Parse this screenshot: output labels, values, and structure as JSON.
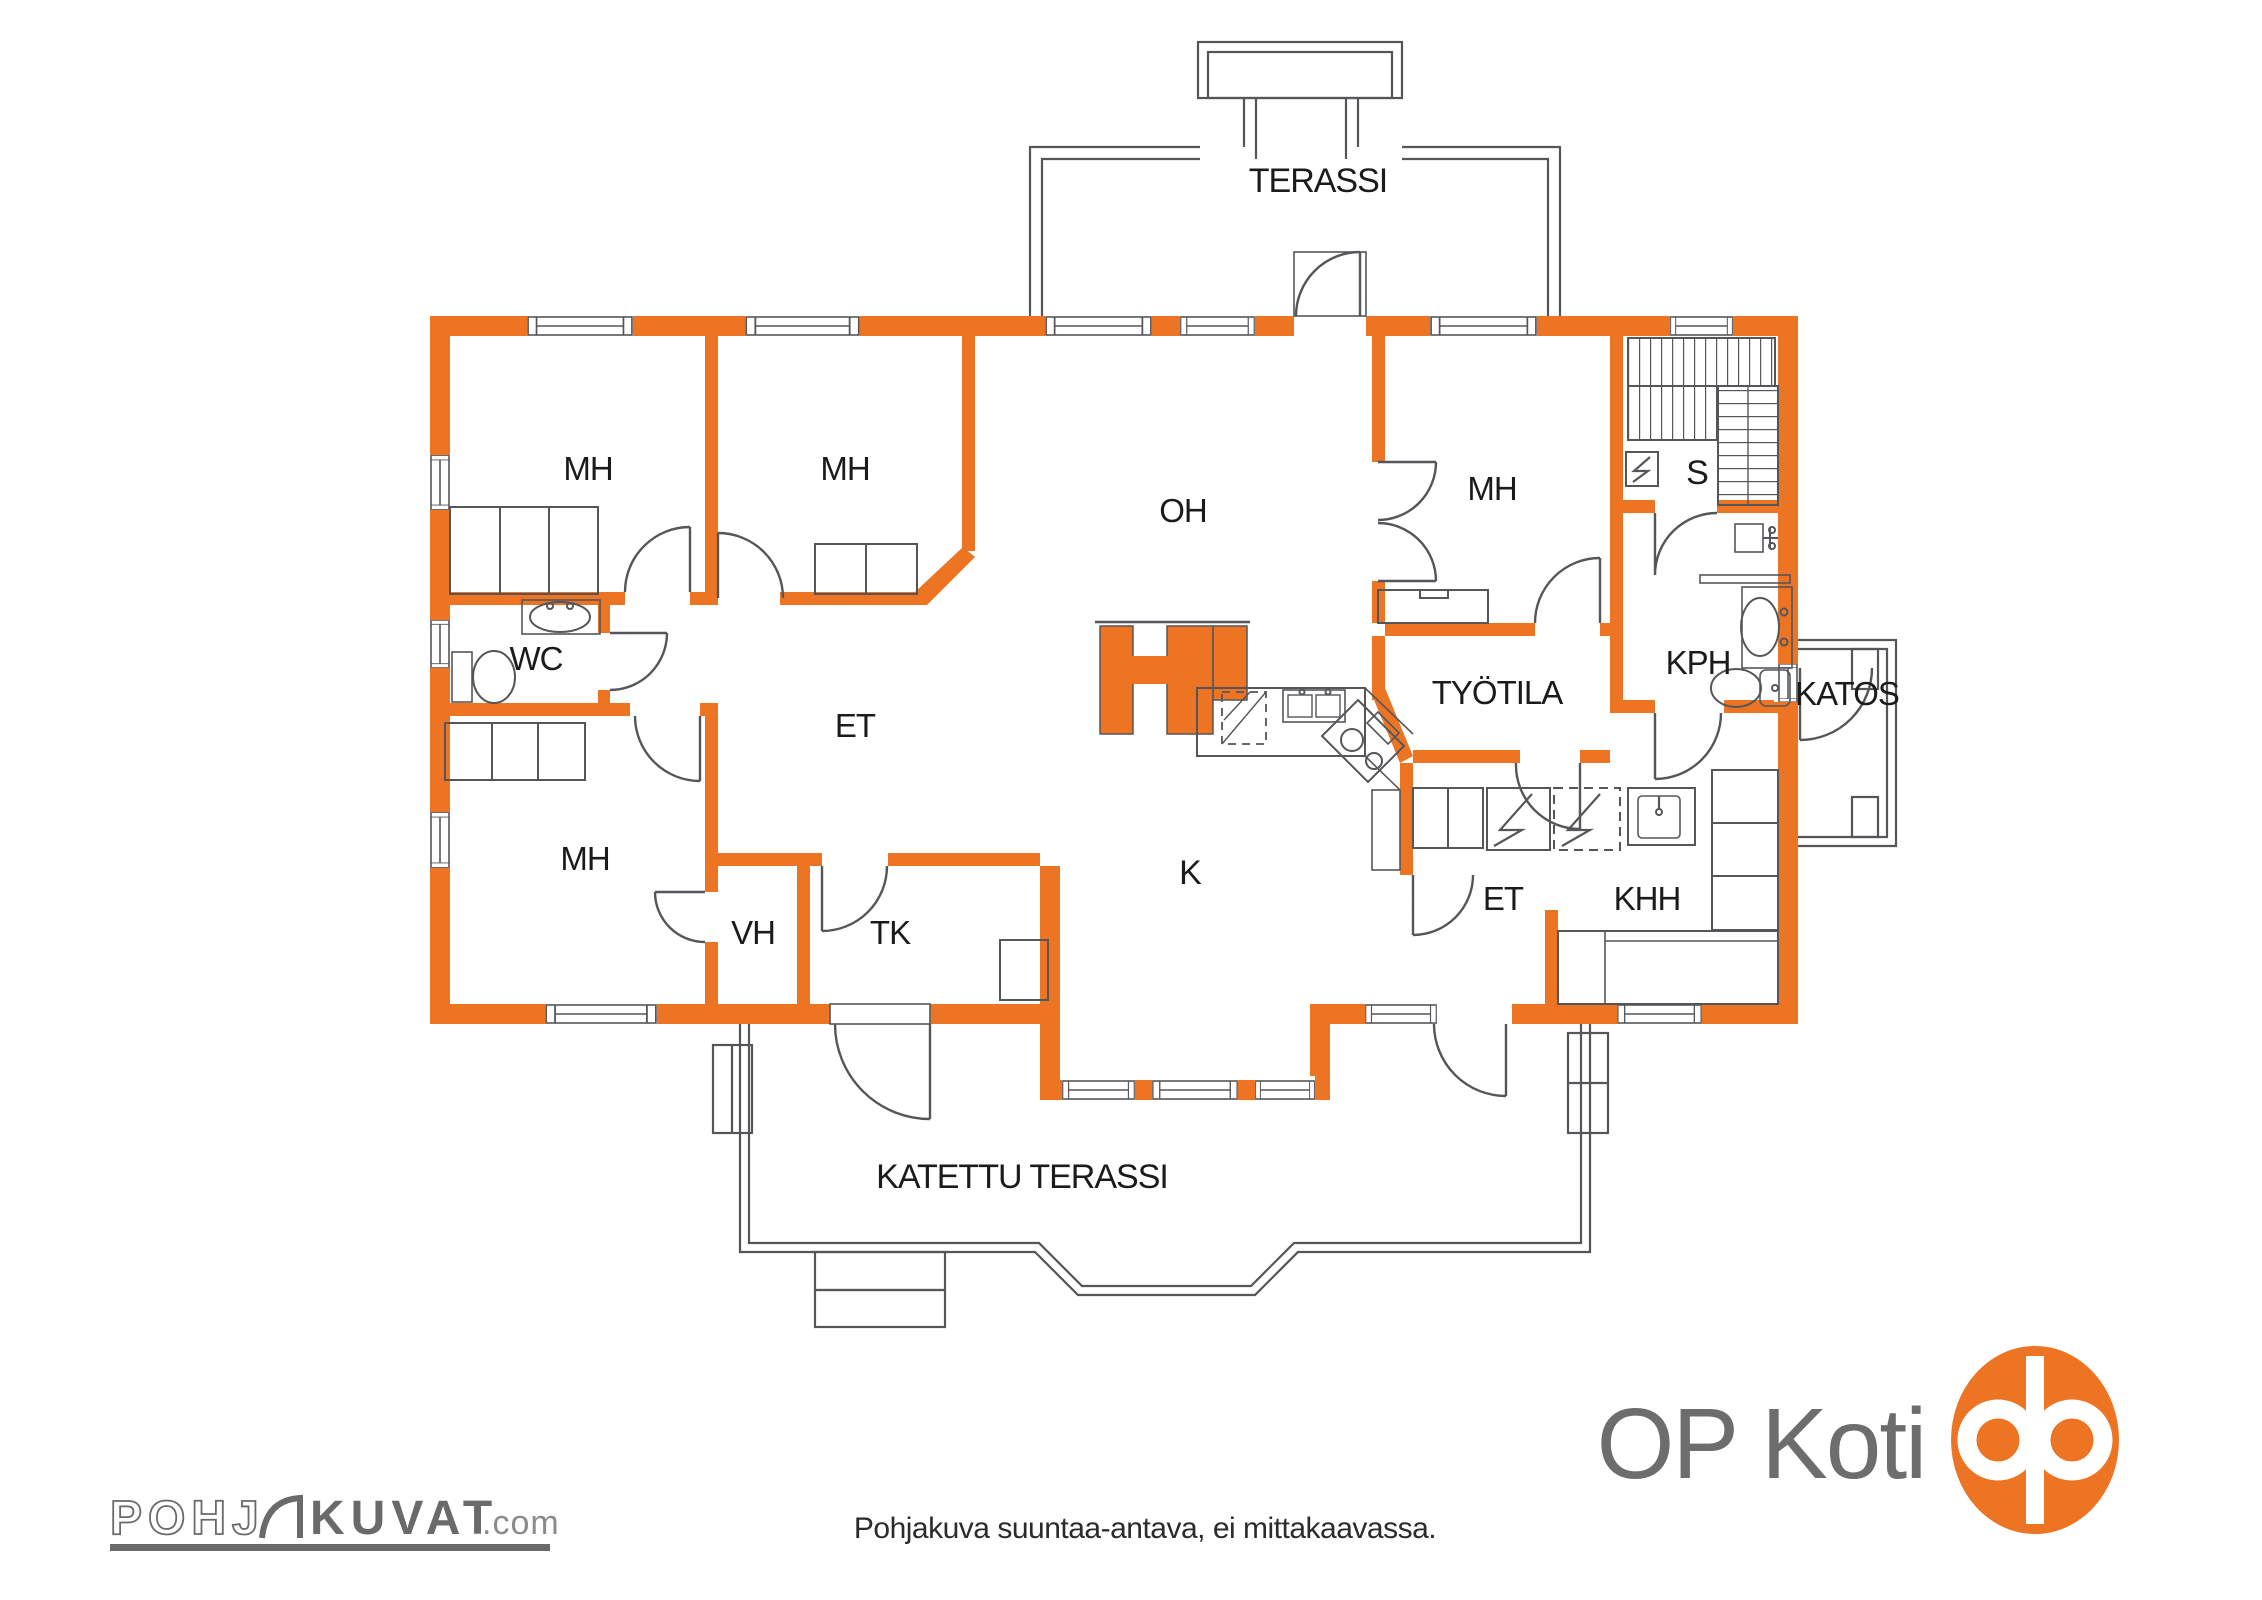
{
  "colors": {
    "wall_orange": "#ED7423",
    "line_gray": "#54565A",
    "text_black": "#1B1B1B",
    "logo_gray": "#6D6D6E"
  },
  "rooms": [
    {
      "id": "terassi",
      "label": "TERASSI"
    },
    {
      "id": "mh-top-left",
      "label": "MH"
    },
    {
      "id": "mh-top-mid",
      "label": "MH"
    },
    {
      "id": "oh",
      "label": "OH"
    },
    {
      "id": "mh-top-right",
      "label": "MH"
    },
    {
      "id": "sauna",
      "label": "S"
    },
    {
      "id": "wc",
      "label": "WC"
    },
    {
      "id": "et-hall",
      "label": "ET"
    },
    {
      "id": "kph",
      "label": "KPH"
    },
    {
      "id": "katos",
      "label": "KATOS"
    },
    {
      "id": "tyotila",
      "label": "TYÖTILA"
    },
    {
      "id": "mh-bottom-left",
      "label": "MH"
    },
    {
      "id": "kitchen",
      "label": "K"
    },
    {
      "id": "vh",
      "label": "VH"
    },
    {
      "id": "tk",
      "label": "TK"
    },
    {
      "id": "et-utility",
      "label": "ET"
    },
    {
      "id": "khh",
      "label": "KHH"
    },
    {
      "id": "katettu-terassi",
      "label": "KATETTU TERASSI"
    }
  ],
  "footer": {
    "disclaimer": "Pohjakuva suuntaa-antava, ei mittakaavassa."
  },
  "branding": {
    "op_koti": "OP Koti",
    "pohjakuvat_pre": "POHJ",
    "pohjakuvat_main": "KUVAT",
    "pohjakuvat_suffix": ".com"
  }
}
